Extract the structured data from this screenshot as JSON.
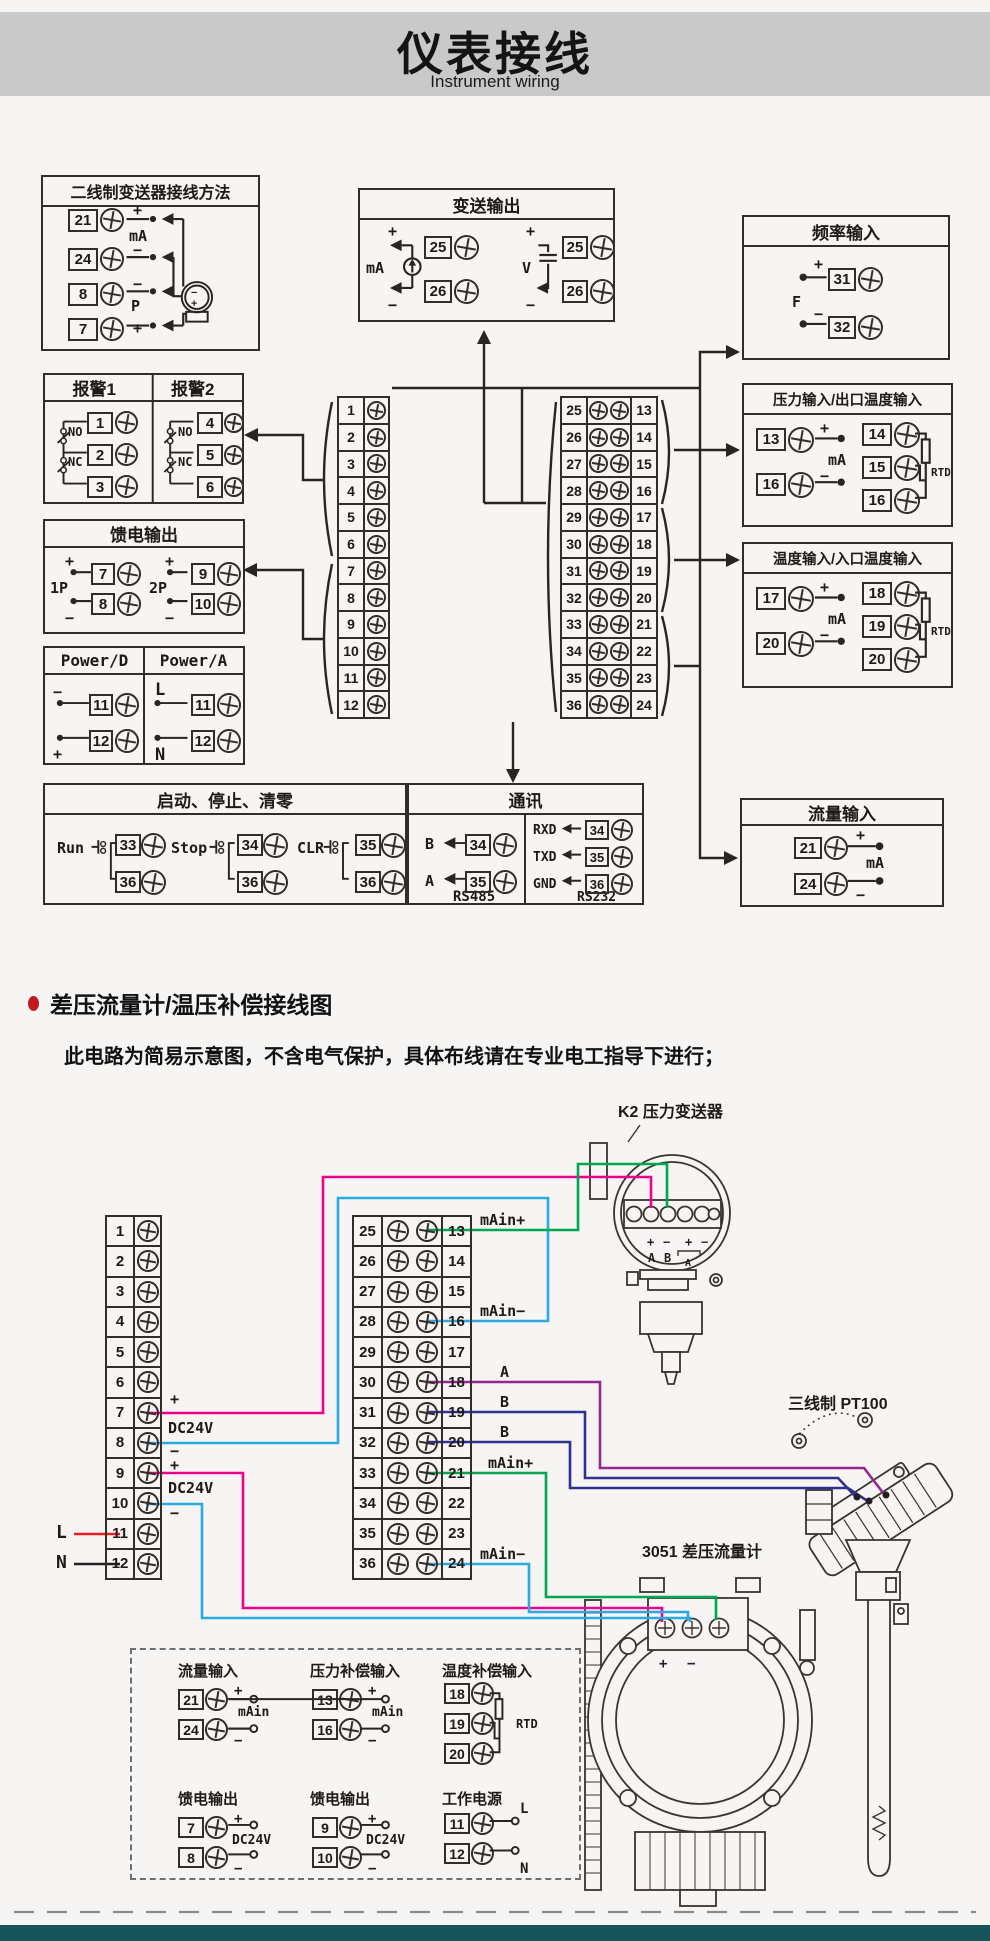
{
  "header": {
    "title": "仪表接线",
    "subtitle": "Instrument wiring"
  },
  "sym": {
    "plus": "+",
    "minus": "−",
    "ma": "mA",
    "p": "P",
    "v": "V",
    "f": "F",
    "l": "L",
    "n": "N",
    "no": "NO",
    "nc": "NC",
    "p1": "1P",
    "p2": "2P",
    "dc24v": "DC24V",
    "rtd": "RTD",
    "a": "A",
    "b": "B",
    "main": "mAin",
    "main_p": "mAin+",
    "main_m": "mAin−",
    "rs485": "RS485",
    "rs232": "RS232",
    "rxd": "RXD",
    "txd": "TXD",
    "gnd": "GND",
    "run": "Run",
    "stop": "Stop",
    "clr": "CLR",
    "power_d": "Power/D",
    "power_a": "Power/A"
  },
  "s1": {
    "two_wire": {
      "title": "二线制变送器接线方法",
      "terms": [
        "21",
        "24",
        "8",
        "7"
      ]
    },
    "alarm": {
      "t1": "报警1",
      "t2": "报警2",
      "a": [
        "1",
        "2",
        "3"
      ],
      "b": [
        "4",
        "5",
        "6"
      ]
    },
    "feed": {
      "title": "馈电输出",
      "a": [
        "7",
        "8"
      ],
      "b": [
        "9",
        "10"
      ]
    },
    "power": {
      "d": [
        "11",
        "12"
      ],
      "a": [
        "11",
        "12"
      ]
    },
    "runstop": {
      "title": "启动、停止、清零",
      "g": [
        {
          "lbl": "Run",
          "t": [
            "33",
            "36"
          ]
        },
        {
          "lbl": "Stop",
          "t": [
            "34",
            "36"
          ]
        },
        {
          "lbl": "CLR",
          "t": [
            "35",
            "36"
          ]
        }
      ]
    },
    "comm": {
      "title": "通讯",
      "rs485": [
        {
          "s": "B",
          "t": "34"
        },
        {
          "s": "A",
          "t": "35"
        }
      ],
      "rs232": [
        {
          "s": "RXD",
          "t": "34"
        },
        {
          "s": "TXD",
          "t": "35"
        },
        {
          "s": "GND",
          "t": "36"
        }
      ]
    },
    "transmit": {
      "title": "变送输出",
      "t": [
        "25",
        "26"
      ]
    },
    "freq": {
      "title": "频率输入",
      "t": [
        "31",
        "32"
      ]
    },
    "pressure": {
      "title": "压力输入/出口温度输入",
      "l": [
        "13",
        "16"
      ],
      "r": [
        "14",
        "15",
        "16"
      ]
    },
    "temp": {
      "title": "温度输入/入口温度输入",
      "l": [
        "17",
        "20"
      ],
      "r": [
        "18",
        "19",
        "20"
      ]
    },
    "flow": {
      "title": "流量输入",
      "t": [
        "21",
        "24"
      ]
    },
    "strip1": [
      "1",
      "2",
      "3",
      "4",
      "5",
      "6",
      "7",
      "8",
      "9",
      "10",
      "11",
      "12"
    ],
    "strip2L": [
      "25",
      "26",
      "27",
      "28",
      "29",
      "30",
      "31",
      "32",
      "33",
      "34",
      "35",
      "36"
    ],
    "strip2R": [
      "13",
      "14",
      "15",
      "16",
      "17",
      "18",
      "19",
      "20",
      "21",
      "22",
      "23",
      "24"
    ]
  },
  "s2": {
    "heading": "差压流量计/温压补偿接线图",
    "note": "此电路为简易示意图，不含电气保护，具体布线请在专业电工指导下进行；",
    "stripL": [
      "1",
      "2",
      "3",
      "4",
      "5",
      "6",
      "7",
      "8",
      "9",
      "10",
      "11",
      "12"
    ],
    "stripM_L": [
      "25",
      "26",
      "27",
      "28",
      "29",
      "30",
      "31",
      "32",
      "33",
      "34",
      "35",
      "36"
    ],
    "stripM_R": [
      "13",
      "14",
      "15",
      "16",
      "17",
      "18",
      "19",
      "20",
      "21",
      "22",
      "23",
      "24"
    ],
    "side": {
      "t13": "mAin+",
      "t16": "mAin−",
      "t18": "A",
      "t19": "B",
      "t20": "B",
      "t21": "mAin+",
      "t24": "mAin−"
    },
    "k2": "K2 压力变送器",
    "pt100": "三线制 PT100",
    "m3051": "3051 差压流量计",
    "groups": [
      {
        "title": "流量输入",
        "t": [
          "21",
          "24"
        ]
      },
      {
        "title": "压力补偿输入",
        "t": [
          "13",
          "16"
        ]
      },
      {
        "title": "温度补偿输入",
        "t": [
          "18",
          "19",
          "20"
        ]
      },
      {
        "title": "馈电输出",
        "t": [
          "7",
          "8"
        ]
      },
      {
        "title": "馈电输出",
        "t": [
          "9",
          "10"
        ]
      },
      {
        "title": "工作电源",
        "t": [
          "11",
          "12"
        ]
      }
    ]
  },
  "colors": {
    "magenta": "#ec008c",
    "cyan": "#29abe2",
    "green": "#00a651",
    "navy": "#2e3192",
    "purple": "#93278f",
    "red": "#ed1c24",
    "black": "#231f20",
    "line": "#332c28",
    "footer": "#17535b"
  }
}
